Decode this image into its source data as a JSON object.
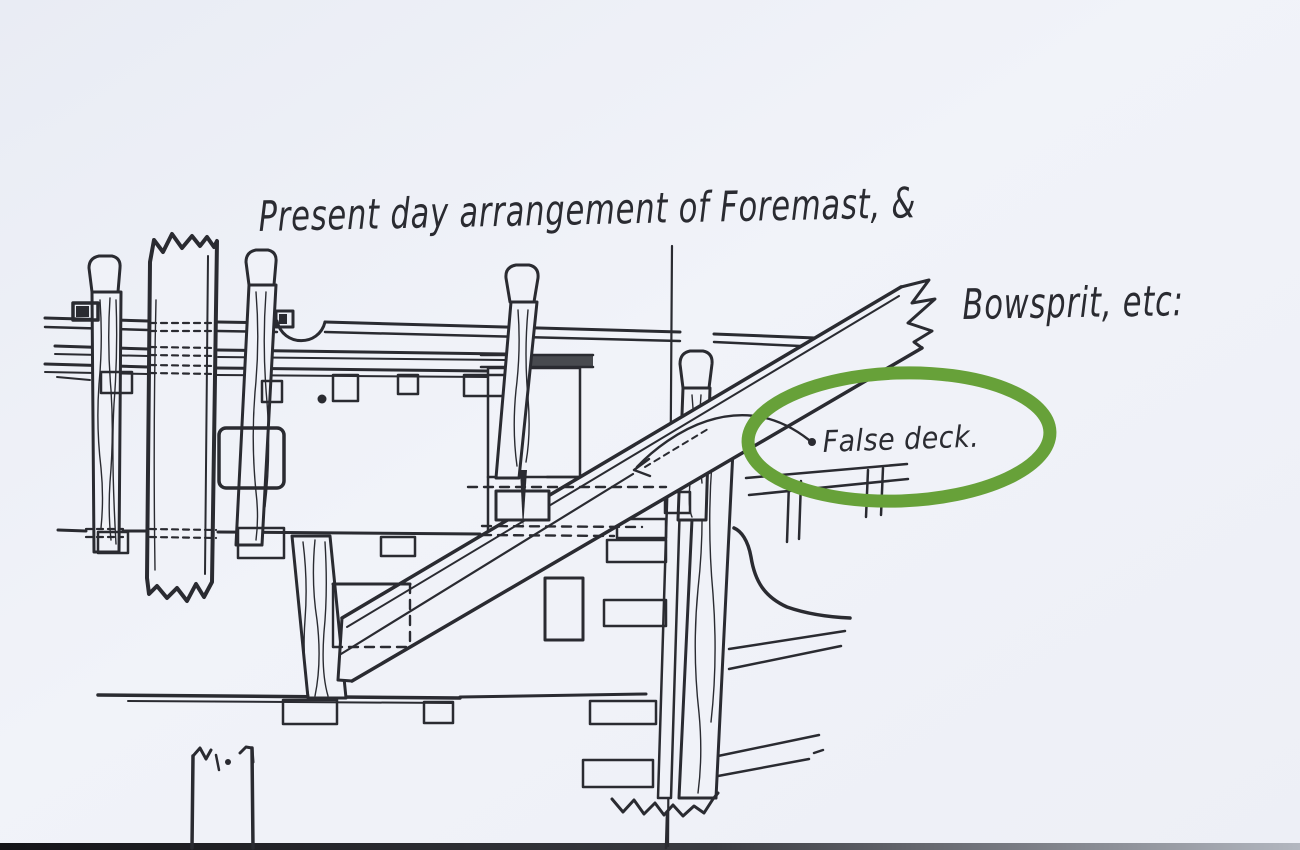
{
  "document": {
    "title_line1": "Present day arrangement of Foremast, &",
    "title_line2": "Bowsprit, etc:",
    "annotation_label": "False deck."
  },
  "annotation": {
    "highlight_shape": "green-ellipse",
    "leader": "curved arrow with dot pointing to false deck line"
  },
  "colors": {
    "paper": "#f0f2f8",
    "paper_edge": "#e9ecf4",
    "ink": "#2a2b31",
    "highlight_green": "#67a139",
    "bottom_strip_dark": "#1c1c20",
    "bottom_strip_light": "#aeb2bb"
  }
}
